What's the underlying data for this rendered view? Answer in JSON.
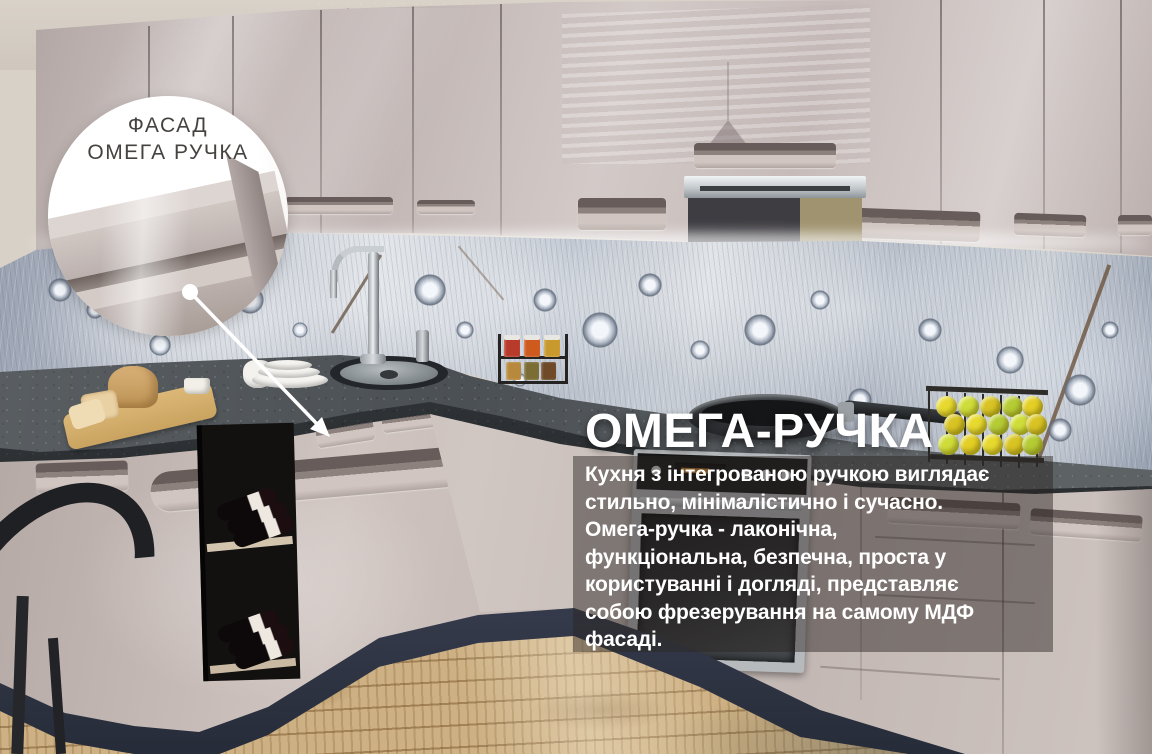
{
  "callout": {
    "line1": "ФАСАД",
    "line2": "ОМЕГА РУЧКА"
  },
  "promo": {
    "title": "ОМЕГА-РУЧКА",
    "body_lines": [
      "Кухня з інтегрованою ручкою виглядає",
      "стильно, мінімалістично і сучасно.",
      "Омега-ручка - лаконічна,",
      "функціональна, безпечна, проста у",
      "користуванні і догляді, представляє",
      "собою фрезерування на самому МДФ",
      "фасаді."
    ]
  },
  "colors": {
    "cabinet_facade": "#c6bbb7",
    "countertop_granite": "#4b5054",
    "plinth_navy": "#303646",
    "floor_wood": "#cdb083",
    "backsplash_feather": "#b8bfca",
    "overlay_panel": "rgba(42,37,33,0.47)",
    "promo_text": "#ffffff",
    "callout_background": "#ffffff",
    "callout_text": "#45423f"
  }
}
